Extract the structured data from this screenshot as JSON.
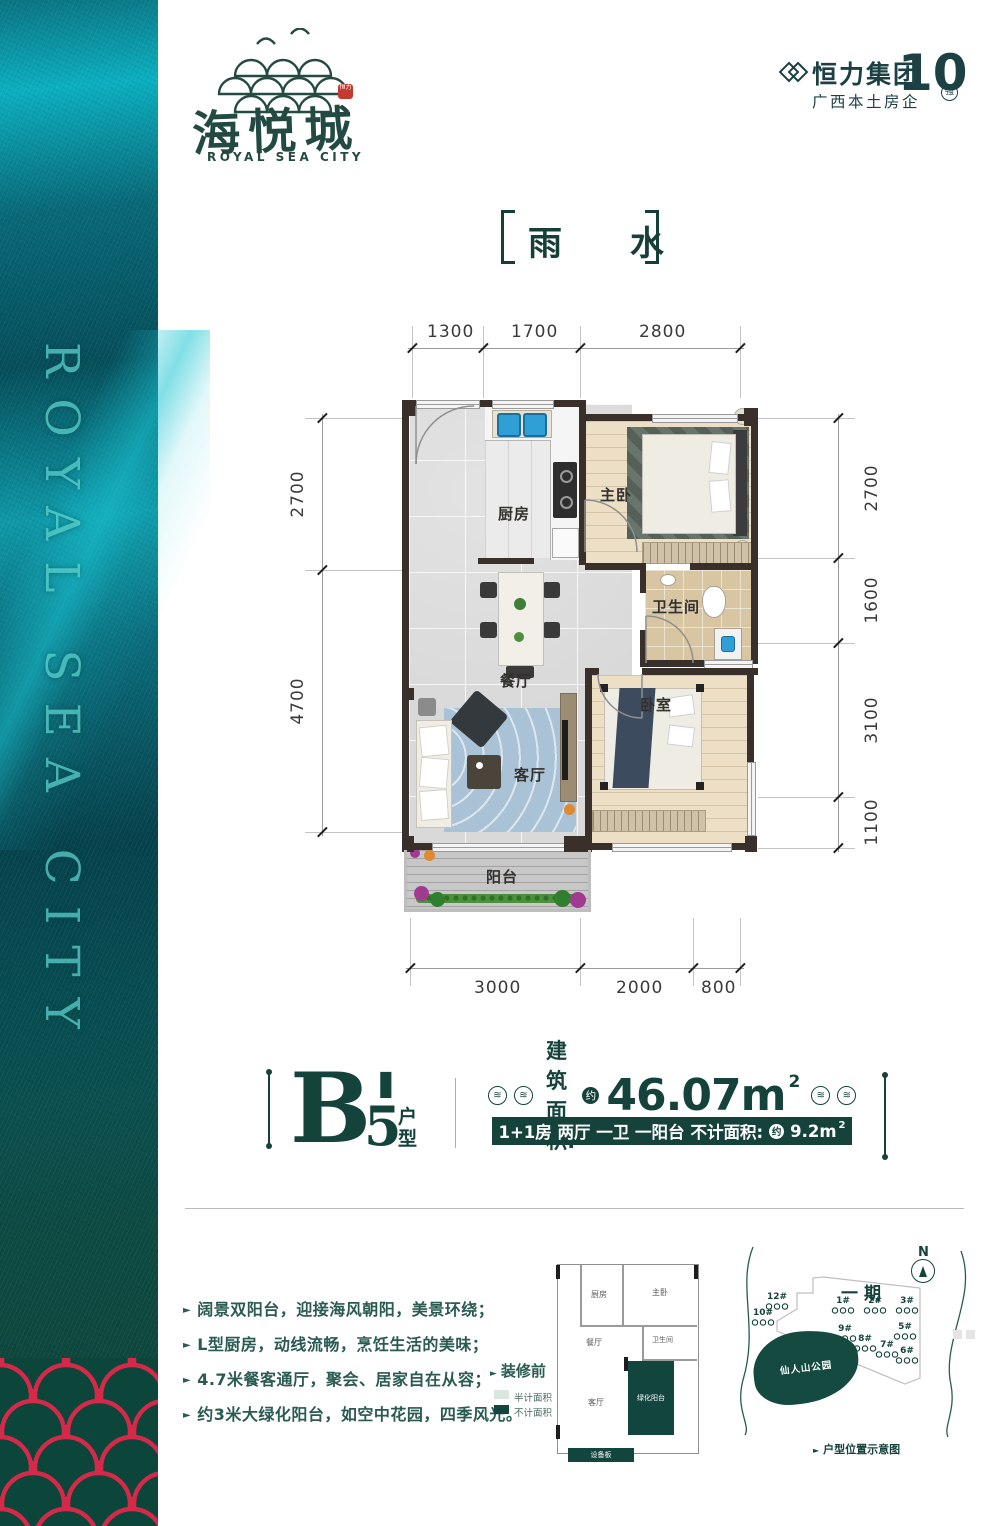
{
  "brand": {
    "name_cn": "海悦城",
    "name_en": "ROYAL SEA CITY",
    "seal": "恒力",
    "side_vertical_text": "ROYAL SEA CITY"
  },
  "developer": {
    "group_name": "恒力集团",
    "tagline": "广西本土房企",
    "rank_number": "10",
    "rank_badge": "强"
  },
  "solar_term": "雨 水",
  "plan": {
    "rooms": {
      "kitchen": "厨房",
      "master_bedroom": "主卧",
      "bathroom": "卫生间",
      "dining": "餐厅",
      "bedroom": "卧室",
      "living": "客厅",
      "balcony": "阳台"
    },
    "dims_top": [
      "1300",
      "1700",
      "2800"
    ],
    "dims_left": [
      "2700",
      "4700"
    ],
    "dims_right": [
      "2700",
      "1600",
      "3100",
      "1100"
    ],
    "dims_bottom": [
      "3000",
      "2000",
      "800"
    ]
  },
  "unit": {
    "code_letter": "B'",
    "code_number": "5",
    "type_char_top": "户",
    "type_char_bottom": "型",
    "area_label": "建筑面积:",
    "approx": "约",
    "area_value": "46.07m",
    "area_sup": "2",
    "spec_rooms": "1+1房 两厅 一卫 一阳台",
    "spec_area_label": "不计面积:",
    "spec_area_value": "9.2m",
    "spec_area_sup": "2",
    "wave_icon": "≋"
  },
  "features": [
    "阔景双阳台，迎接海风朝阳，美景环绕；",
    "L型厨房，动线流畅，烹饪生活的美味；",
    "4.7米餐客通厅，聚会、居家自在从容；",
    "约3米大绿化阳台，如空中花园，四季风光。"
  ],
  "miniplan": {
    "title": "装修前",
    "legend_half": "半计面积",
    "legend_none": "不计面积",
    "rooms": {
      "kitchen": "厨房",
      "master": "主卧",
      "dining": "餐厅",
      "bath": "卫生间",
      "living": "客厅",
      "green_balcony": "绿化阳台",
      "equipment": "设备板"
    }
  },
  "siteplan": {
    "compass": "N",
    "phase": "一期",
    "park": "仙人山公园",
    "caption": "户型位置示意图",
    "buildings": [
      "12#",
      "10#",
      "1#",
      "2#",
      "3#",
      "9#",
      "8#",
      "7#",
      "5#",
      "6#"
    ]
  }
}
